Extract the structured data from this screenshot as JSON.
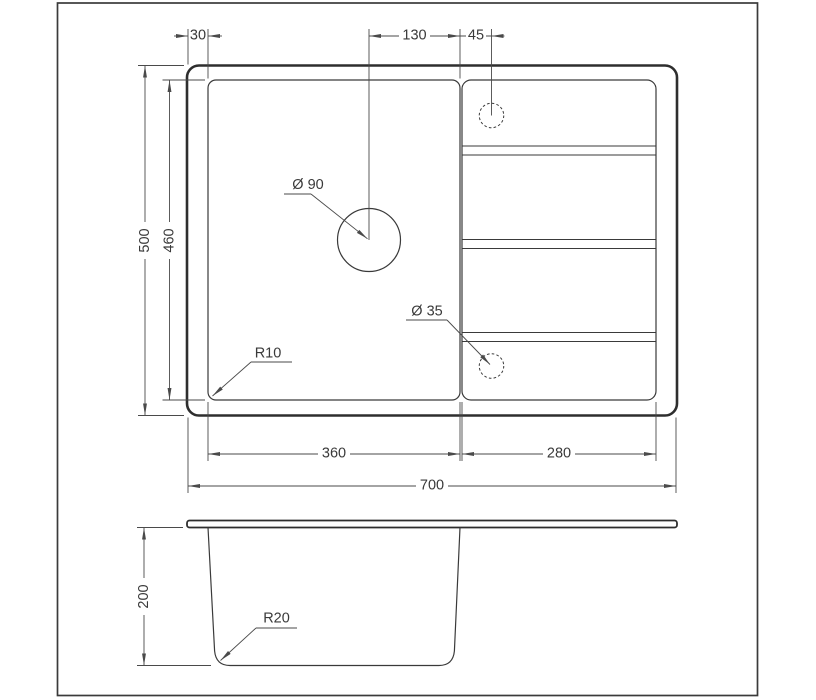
{
  "dimensions": {
    "rim_to_bowl": "30",
    "drain_to_bowl_edge": "130",
    "tap_to_bowl_edge": "45",
    "overall_height": "500",
    "bowl_height": "460",
    "bowl_width": "360",
    "drainboard_width": "280",
    "overall_width": "700",
    "depth": "200"
  },
  "labels": {
    "drain_hole": "Ø 90",
    "tap_hole": "Ø 35",
    "bowl_corner_radius": "R10",
    "bottom_corner_radius": "R20"
  },
  "colors": {
    "line": "#3a3a3a",
    "background": "#ffffff"
  }
}
